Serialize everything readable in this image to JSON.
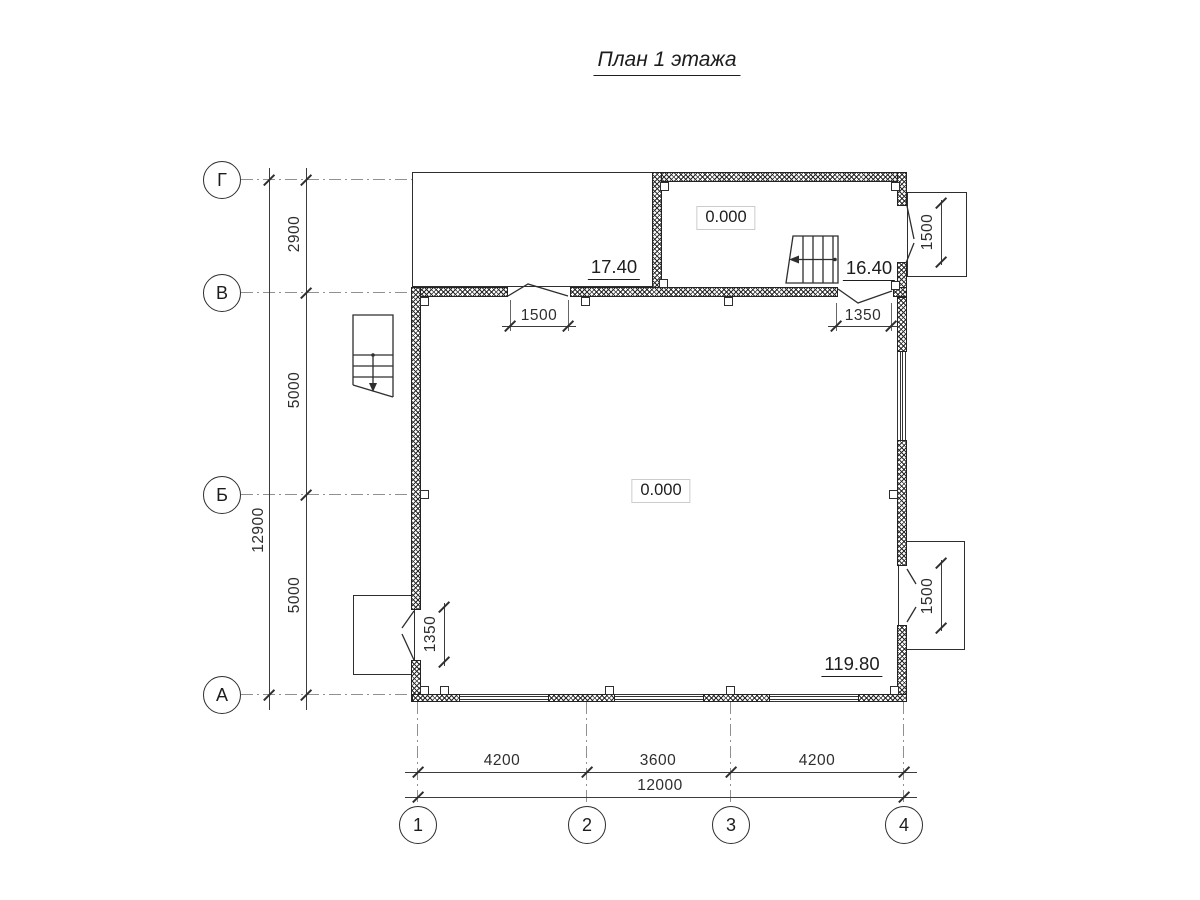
{
  "title": "План 1 этажа",
  "row_axes": [
    {
      "label": "Г"
    },
    {
      "label": "В"
    },
    {
      "label": "Б"
    },
    {
      "label": "А"
    }
  ],
  "col_axes": [
    {
      "label": "1"
    },
    {
      "label": "2"
    },
    {
      "label": "3"
    },
    {
      "label": "4"
    }
  ],
  "dims": {
    "left_overall": "12900",
    "left_seg_gv": "2900",
    "left_seg_vb": "5000",
    "left_seg_ba": "5000",
    "bottom_overall": "12000",
    "bottom_seg_12": "4200",
    "bottom_seg_23": "3600",
    "bottom_seg_34": "4200",
    "door_terrace": "1500",
    "door_hall": "1350",
    "porch_top_right": "1500",
    "porch_bottom_right": "1500",
    "porch_bottom_left": "1350"
  },
  "elevations": {
    "terrace": "17.40",
    "upper_room": "0.000",
    "stairs": "16.40",
    "main_room": "0.000",
    "entrance": "119.80"
  }
}
